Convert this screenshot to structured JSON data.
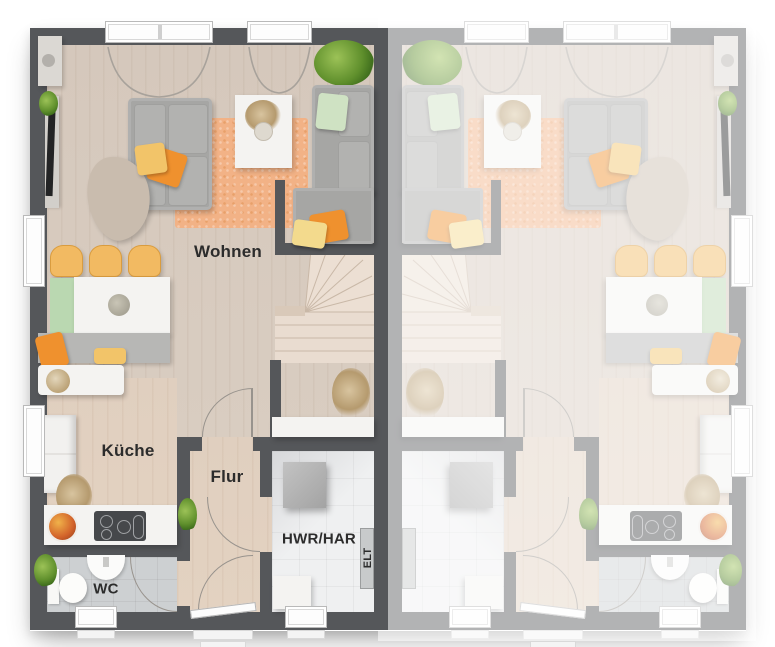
{
  "plan": {
    "type": "floor-plan",
    "units_count": 2
  },
  "rooms": {
    "wohnen": "Wohnen",
    "kueche": "Küche",
    "flur": "Flur",
    "hwr": "HWR/HAR",
    "wc": "WC",
    "elt": "ELT"
  },
  "units": {
    "left": {
      "id": "unit-left",
      "labels": true,
      "faded": false,
      "mirrored": false
    },
    "right": {
      "id": "unit-right",
      "labels": false,
      "faded": true,
      "mirrored": true
    }
  },
  "colors": {
    "wall": "#55575a",
    "floorWood": "#d5c8bc",
    "floorWarm": "#e0cfbf",
    "floorWC": "#cdd0d2",
    "floorTile": "#eff0f1",
    "stairs": "#e9ddd1",
    "rug": "#f2b286",
    "sofa": "#a6a6a4",
    "orange": "#ef912e",
    "yellow": "#f2c469",
    "paleYellow": "#f3da8d",
    "greenPillow": "#cfe2c3",
    "benchGreen": "#bad8b1",
    "chair": "#f2ba62",
    "white": "#f4f3f1",
    "cooktop": "#46484b",
    "washer": "#b3b3b3",
    "doorArc": "#98938d",
    "label": "#2c2c2c",
    "fade": "rgba(255,255,255,0.55)"
  }
}
